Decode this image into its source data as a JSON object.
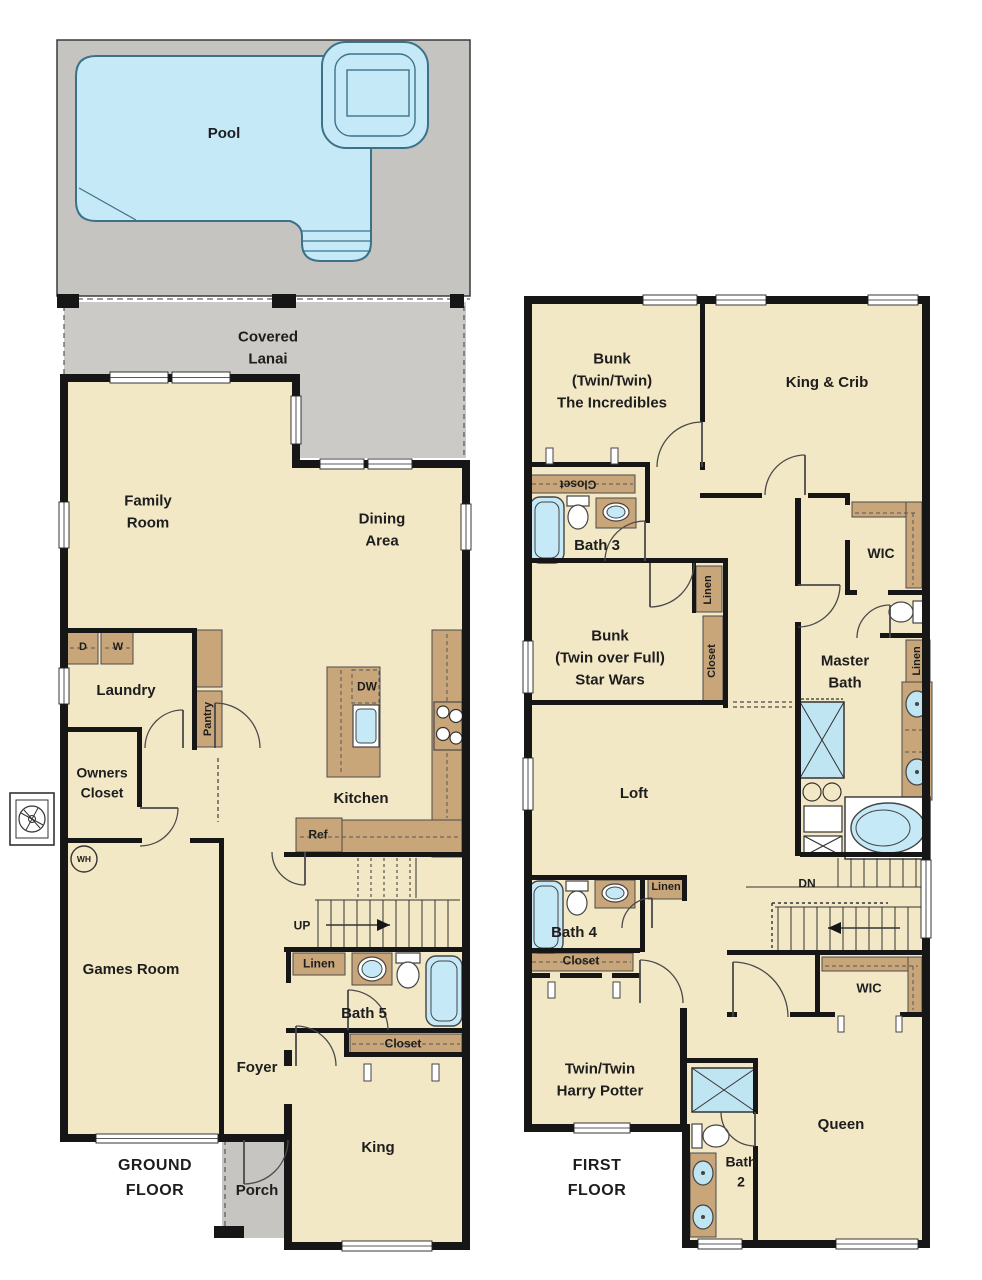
{
  "plan": {
    "type": "two-story vacation home floor plan",
    "colors": {
      "room_fill": "#f3e8c6",
      "pool_deck": "#c6c4c0",
      "lanai": "#cbcac6",
      "porch": "#c6c5c1",
      "water": "#c6e9f8",
      "cabinet": "#c9a67a",
      "wall": "#161616"
    }
  },
  "ground_floor": {
    "title": "GROUND\nFLOOR",
    "labels": {
      "pool": "Pool",
      "covered_lanai": "Covered\nLanai",
      "family_room": "Family\nRoom",
      "dining_area": "Dining\nArea",
      "laundry": "Laundry",
      "dryer": "D",
      "washer": "W",
      "pantry": "Pantry",
      "owners_closet": "Owners\nCloset",
      "kitchen": "Kitchen",
      "dishwasher": "DW",
      "refrigerator": "Ref",
      "water_heater": "WH",
      "games_room": "Games Room",
      "stairs_up": "UP",
      "linen": "Linen",
      "bath_5": "Bath 5",
      "closet": "Closet",
      "foyer": "Foyer",
      "king_bedroom": "King",
      "porch": "Porch"
    }
  },
  "first_floor": {
    "title": "FIRST\nFLOOR",
    "labels": {
      "bunk_twin_twin": "Bunk\n(Twin/Twin)\nThe Incredibles",
      "king_crib": "King & Crib",
      "closet_bunk1": "Closet",
      "bath_3": "Bath 3",
      "wic_master": "WIC",
      "linen_hall": "Linen",
      "closet_bunk2": "Closet",
      "bunk_twin_full": "Bunk\n(Twin over Full)\nStar Wars",
      "master_bath": "Master\nBath",
      "linen_master": "Linen",
      "loft": "Loft",
      "stairs_dn": "DN",
      "bath_4": "Bath 4",
      "linen_bath4": "Linen",
      "closet_bath4": "Closet",
      "twin_twin_hp": "Twin/Twin\nHarry Potter",
      "wic_queen": "WIC",
      "queen_bedroom": "Queen",
      "bath_2": "Bath\n2"
    }
  }
}
